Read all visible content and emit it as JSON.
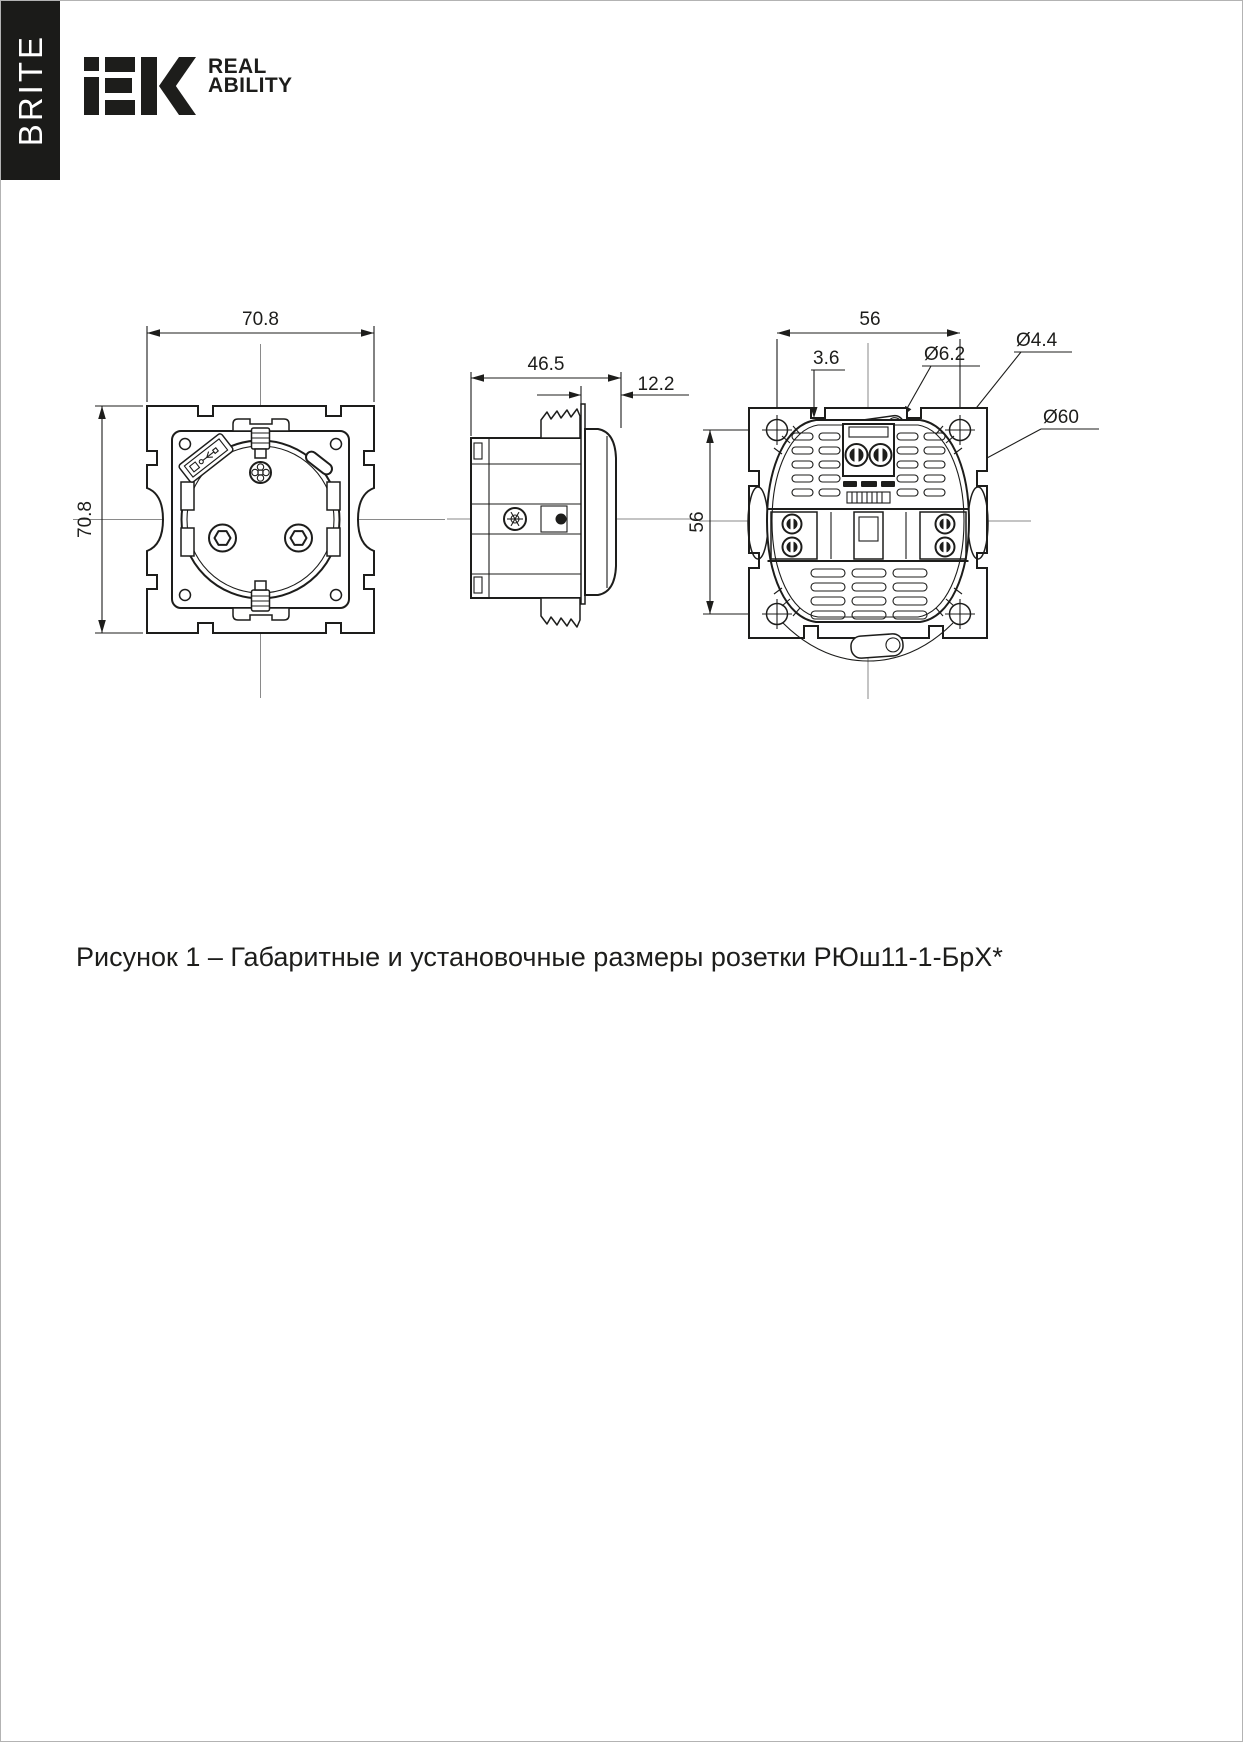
{
  "brand": {
    "series": "BRITE",
    "logo": "iEK",
    "tagline_line1": "REAL",
    "tagline_line2": "ABILITY"
  },
  "figure": {
    "caption": "Рисунок 1 – Габаритные и установочные размеры розетки РЮш11-1-БрХ*"
  },
  "drawing": {
    "front_view": {
      "dim_width": "70.8",
      "dim_height": "70.8"
    },
    "side_view": {
      "dim_depth_total": "46.5",
      "dim_depth_front": "12.2"
    },
    "rear_view": {
      "dim_mount_width": "56",
      "dim_mount_height": "56",
      "dim_edge_gap": "3.6",
      "dia_mount_slot": "Ø6.2",
      "dia_screw_hole": "Ø4.4",
      "dia_support_body": "Ø60"
    }
  }
}
